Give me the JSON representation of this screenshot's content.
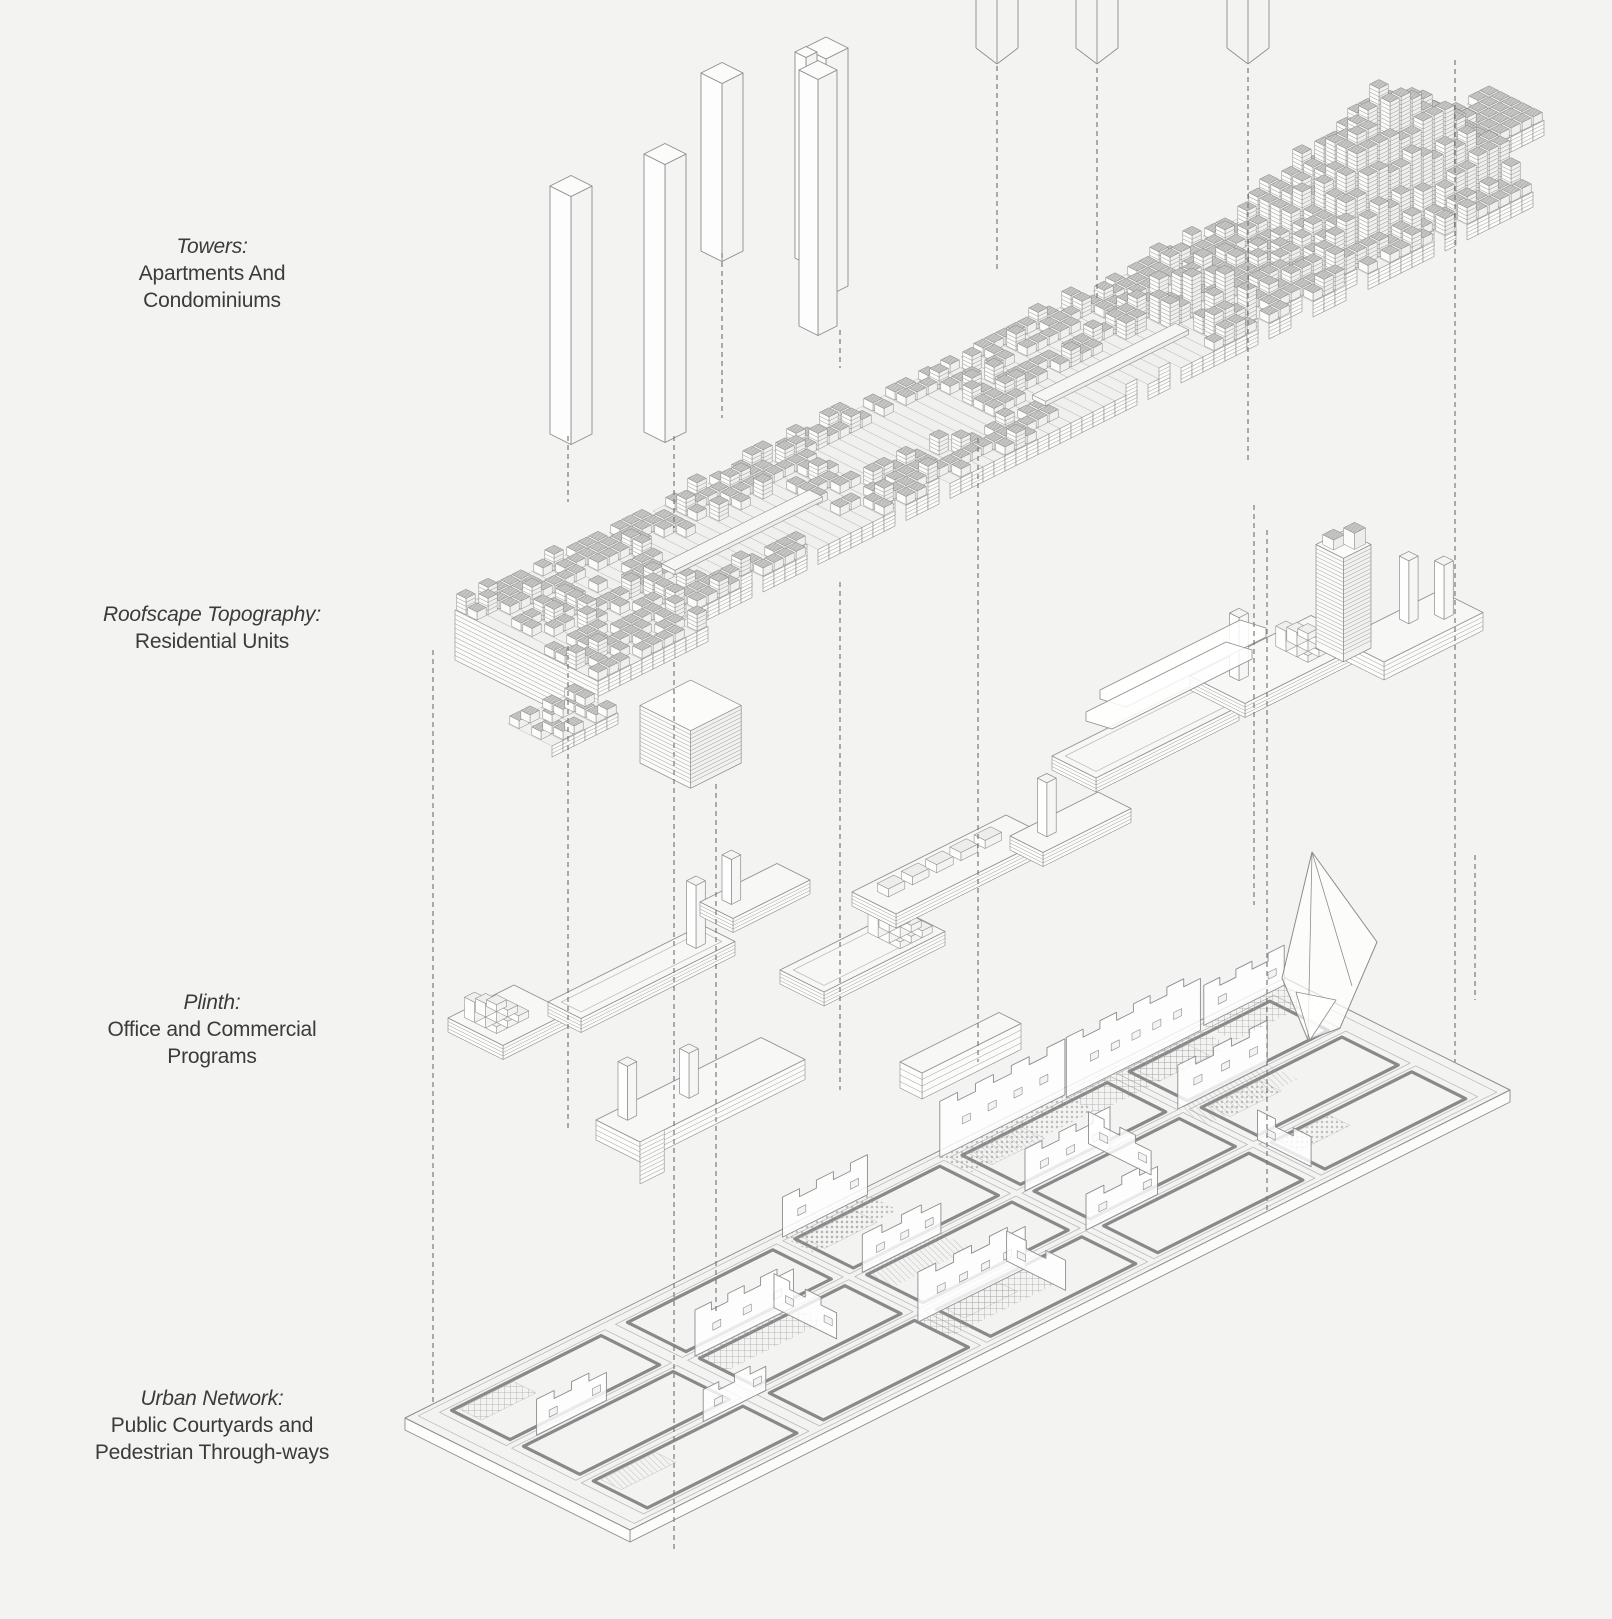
{
  "page": {
    "title": "Exploded axonometric urban design diagram",
    "background": "#f3f3f2"
  },
  "labels": [
    {
      "id": "towers",
      "title": "Towers:",
      "lines": [
        "Apartments And",
        "Condominiums"
      ]
    },
    {
      "id": "roofscape",
      "title": "Roofscape Topography:",
      "lines": [
        "Residential Units"
      ]
    },
    {
      "id": "plinth",
      "title": "Plinth:",
      "lines": [
        "Office and Commercial",
        "Programs"
      ]
    },
    {
      "id": "urban-network",
      "title": "Urban Network:",
      "lines": [
        "Public Courtyards and",
        "Pedestrian Through-ways"
      ]
    }
  ],
  "colors": {
    "background": "#f3f3f2",
    "line": "#8d8d8d",
    "line_dark": "#6e6e6e",
    "line_light": "#b9b9b9",
    "block_top": "#c6c6c5",
    "block_hatch_line": "#8e8e8e",
    "face_light": "#fbfbfa",
    "face_mid": "#ededec",
    "slab_top": "#f7f7f6",
    "guide": "#7a7a7a",
    "courtyard_border": "#898989",
    "text": "#3b3b3b"
  }
}
